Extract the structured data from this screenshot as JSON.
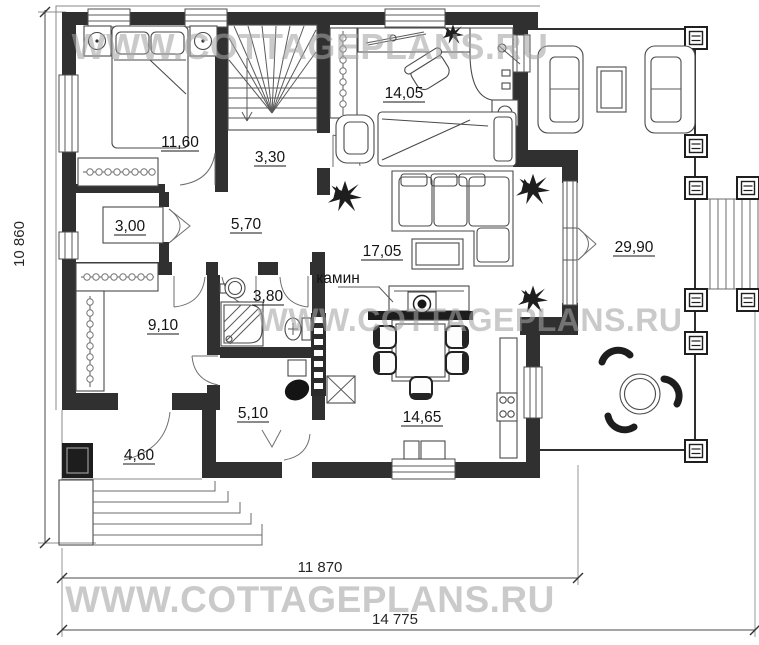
{
  "watermark": {
    "text": "WWW.COTTAGEPLANS.RU",
    "color": "#a3a3a3"
  },
  "rooms": {
    "bedroom": {
      "area": "11,60"
    },
    "stairs": {
      "area": "3,30"
    },
    "study": {
      "area": "14,05"
    },
    "closet": {
      "area": "3,00"
    },
    "hall": {
      "area": "5,70"
    },
    "living": {
      "area": "17,05"
    },
    "terrace": {
      "area": "29,90"
    },
    "wardrobe": {
      "area": "9,10"
    },
    "bathroom": {
      "area": "3,80"
    },
    "corridor": {
      "area": "5,10"
    },
    "kitchen": {
      "area": "14,65"
    },
    "porch": {
      "area": "4,60"
    }
  },
  "annotations": {
    "fireplace": "камин"
  },
  "dimensions": {
    "left": "10 860",
    "bottom_inner": "11 870",
    "bottom_outer": "14 775"
  },
  "colors": {
    "wall": "#303030",
    "label": "#141414",
    "furniture_line": "#4a4a4a"
  }
}
